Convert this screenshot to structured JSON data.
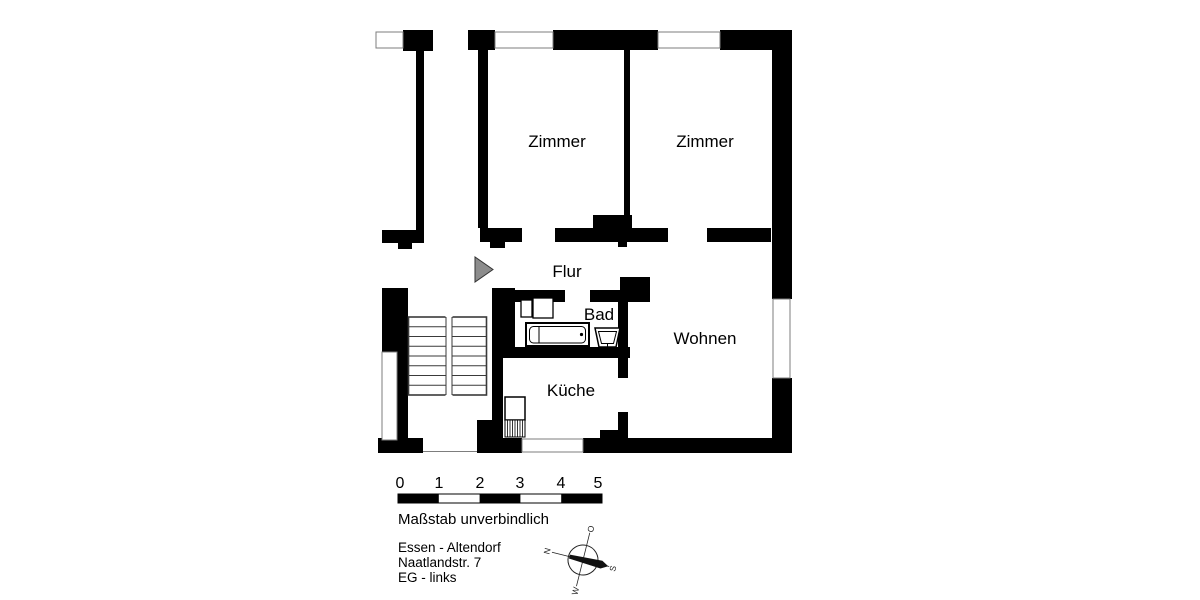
{
  "floor_plan": {
    "rooms": {
      "zimmer_1": "Zimmer",
      "zimmer_2": "Zimmer",
      "flur": "Flur",
      "bad": "Bad",
      "kueche": "Küche",
      "wohnen": "Wohnen"
    }
  },
  "scale_bar": {
    "ticks": [
      "0",
      "1",
      "2",
      "3",
      "4",
      "5"
    ],
    "note": "Maßstab unverbindlich"
  },
  "location": {
    "city": "Essen - Altendorf",
    "street": "Naatlandstr. 7",
    "floor": "EG - links"
  },
  "compass": {
    "north": "N",
    "east": "O",
    "south": "S",
    "west": "W"
  },
  "colors": {
    "wall": "#000000",
    "window_outline": "#7d7d7d",
    "entrance_marker": "#8c8c8c",
    "background": "#ffffff"
  }
}
